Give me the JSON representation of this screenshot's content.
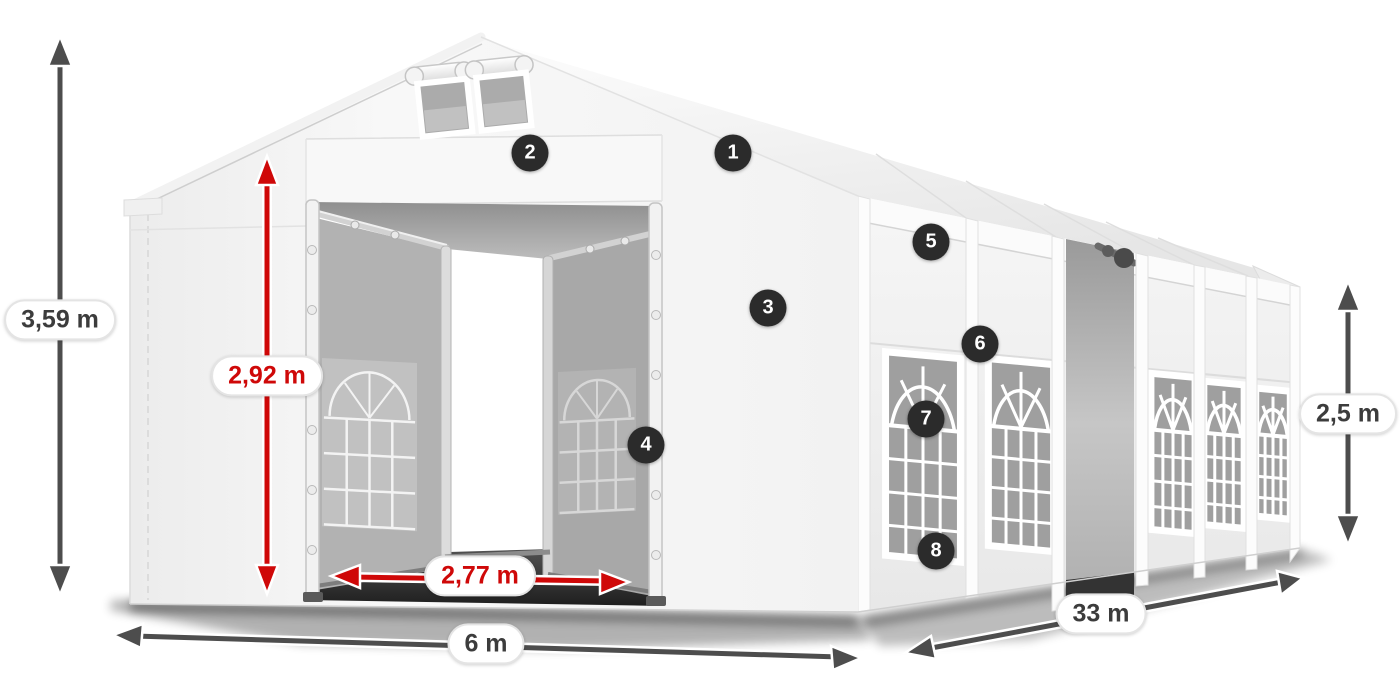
{
  "product_diagram": {
    "description_markers": [
      {
        "number": "1",
        "x": 733,
        "y": 153
      },
      {
        "number": "2",
        "x": 530,
        "y": 153
      },
      {
        "number": "3",
        "x": 768,
        "y": 308
      },
      {
        "number": "4",
        "x": 646,
        "y": 445
      },
      {
        "number": "5",
        "x": 931,
        "y": 242
      },
      {
        "number": "6",
        "x": 980,
        "y": 344
      },
      {
        "number": "7",
        "x": 926,
        "y": 419
      },
      {
        "number": "8",
        "x": 936,
        "y": 551
      }
    ],
    "dimensions": [
      {
        "id": "total-height",
        "label": "3,59 m",
        "color": "gray",
        "x": 60,
        "y": 320
      },
      {
        "id": "entrance-height",
        "label": "2,92 m",
        "color": "red",
        "x": 267,
        "y": 376
      },
      {
        "id": "entrance-width",
        "label": "2,77 m",
        "color": "red",
        "x": 480,
        "y": 576
      },
      {
        "id": "front-width",
        "label": "6 m",
        "color": "gray",
        "x": 486,
        "y": 644
      },
      {
        "id": "side-length",
        "label": "33 m",
        "color": "gray",
        "x": 1101,
        "y": 614
      },
      {
        "id": "side-height",
        "label": "2,5 m",
        "color": "gray",
        "x": 1348,
        "y": 414
      }
    ],
    "colors": {
      "dimension_red": "#cf0808",
      "dimension_gray": "#4d4d4d",
      "marker_background": "#2b2b2b",
      "marker_text": "#ffffff",
      "tent_canvas": "#f5f5f5",
      "window_mesh": "#9f9f9f"
    }
  }
}
